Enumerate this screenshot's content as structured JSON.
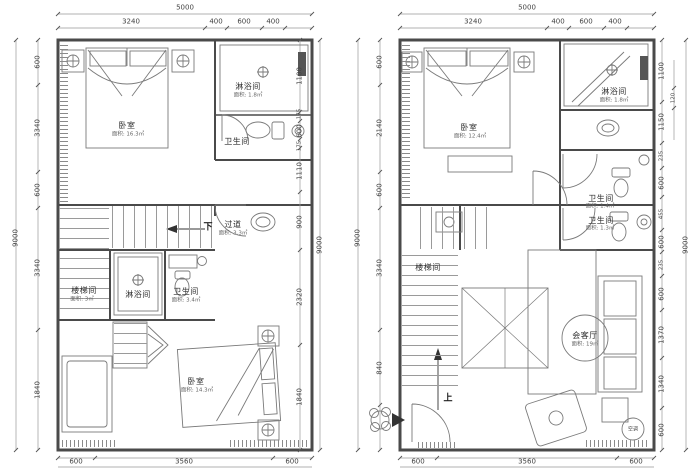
{
  "colors": {
    "wall": "#4a4a4a",
    "furniture": "#7a7a7a",
    "dimension": "#444444"
  },
  "plans": [
    {
      "dims": {
        "top_total": "5000",
        "top": [
          "3240",
          "400",
          "600",
          "400"
        ],
        "left_total": "9000",
        "left": [
          "600",
          "3340",
          "600",
          "3340",
          "1840"
        ],
        "right": [
          "1100",
          "175",
          "600",
          "175",
          "1110",
          "900",
          "2320",
          "1840"
        ],
        "right_total": "9000",
        "bottom": [
          "600",
          "3560",
          "600"
        ]
      },
      "rooms": {
        "bedroom_top": {
          "name": "卧室",
          "area": "面积: 16.3㎡"
        },
        "shower_top": {
          "name": "淋浴间",
          "area": "面积: 1.8㎡"
        },
        "bath_top": {
          "name": "卫生间"
        },
        "corridor": {
          "name": "过道",
          "area": "面积: 3.3㎡"
        },
        "down_label": "下",
        "stairwell": {
          "name": "楼梯间",
          "area": "面积: 3㎡"
        },
        "shower_mid": {
          "name": "淋浴间"
        },
        "bath_mid": {
          "name": "卫生间",
          "area": "面积: 3.4㎡"
        },
        "bedroom_bottom": {
          "name": "卧室",
          "area": "面积: 14.3㎡"
        }
      }
    },
    {
      "dims": {
        "top_total": "5000",
        "top": [
          "3240",
          "400",
          "600",
          "400"
        ],
        "left_total": "9000",
        "left": [
          "600",
          "2140",
          "600",
          "3340",
          "840"
        ],
        "right": [
          "1100",
          "1150",
          "235",
          "600",
          "455",
          "600",
          "235",
          "600",
          "1370",
          "1340",
          "600"
        ],
        "right_wall": "120",
        "right_total": "9000",
        "bottom": [
          "600",
          "3560",
          "600"
        ]
      },
      "rooms": {
        "bedroom": {
          "name": "卧室",
          "area": "面积: 12.4㎡"
        },
        "shower": {
          "name": "淋浴间",
          "area": "面积: 1.8㎡"
        },
        "bath_upper": {
          "name": "卫生间",
          "area": "面积: 1.4㎡"
        },
        "bath_lower": {
          "name": "卫生间",
          "area": "面积: 1.3㎡"
        },
        "stairwell": {
          "name": "楼梯间"
        },
        "living": {
          "name": "会客厅",
          "area": "面积: 19㎡"
        },
        "up_label": "上",
        "ac_label": "空调"
      }
    }
  ]
}
